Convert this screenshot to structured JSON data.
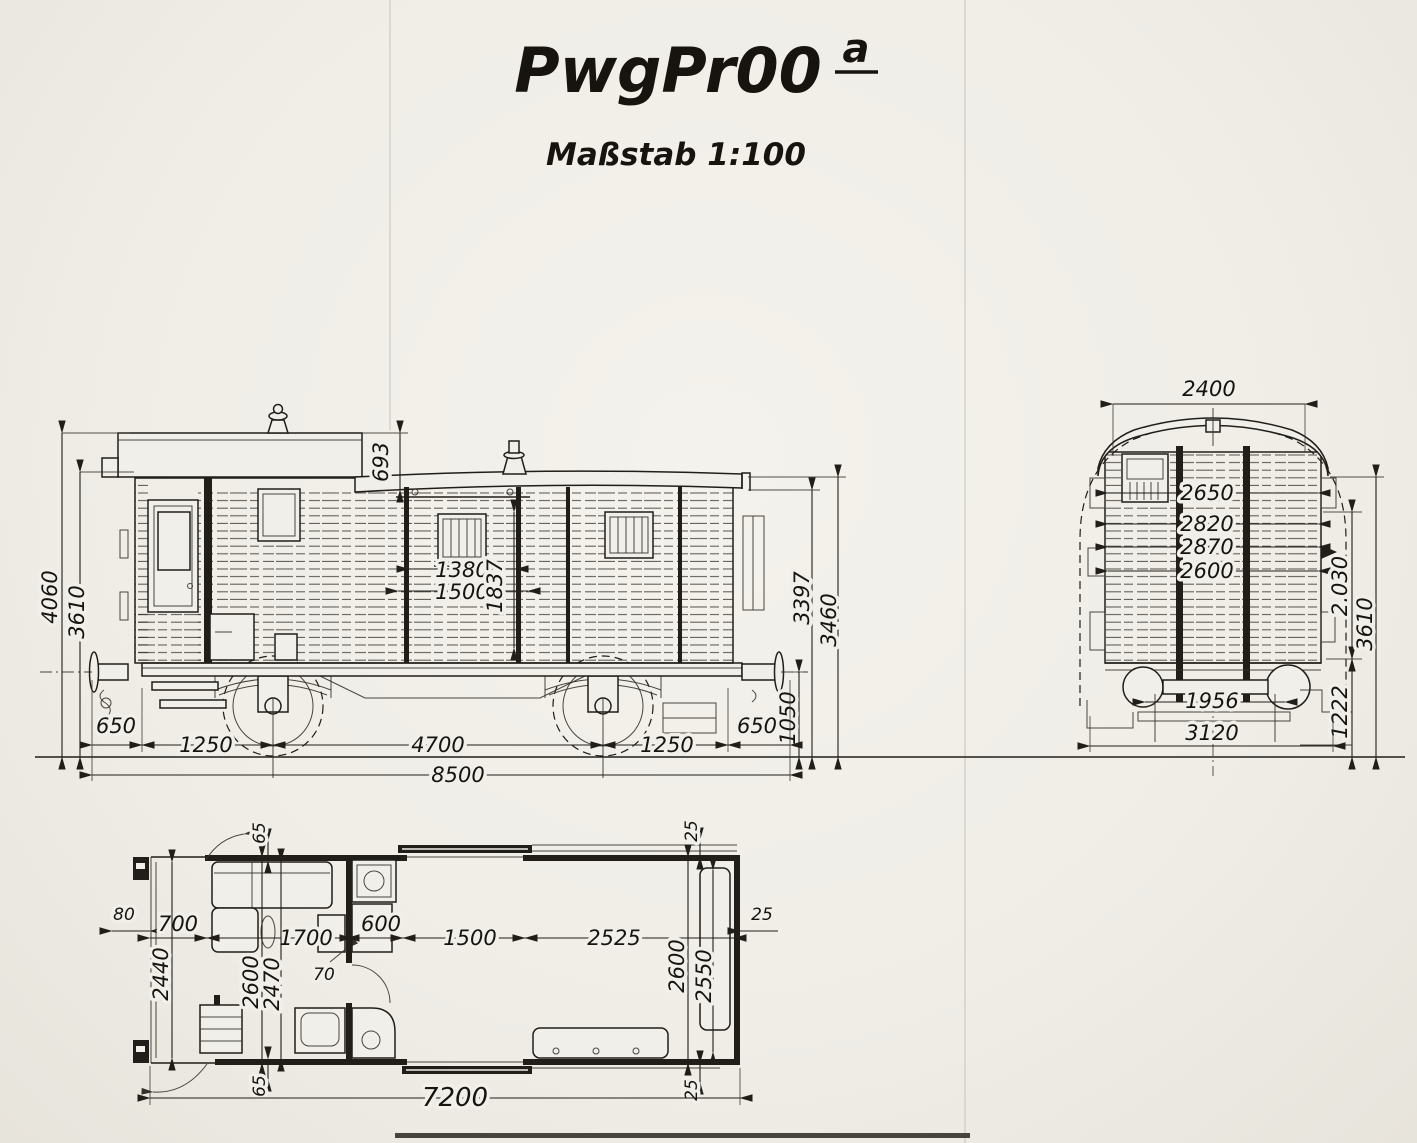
{
  "title": {
    "main": "PwgPr00",
    "superscript": "a"
  },
  "subtitle": "Maßstab 1:100",
  "side_view": {
    "dims": {
      "total_height": "4060",
      "roof_edge_height": "3610",
      "lantern_height": "693",
      "door_clear_width": "1380",
      "door_width": "1500",
      "door_height": "1837",
      "wall_top_height": "3397",
      "roof_top_height": "3460",
      "buffer_height": "1050",
      "left_overhang": "650",
      "left_axle": "1250",
      "wheelbase": "4700",
      "right_axle": "1250",
      "right_overhang": "650",
      "length_over_buffers": "8500"
    }
  },
  "end_view": {
    "dims": {
      "roof_width": "2400",
      "width_a": "2650",
      "width_b": "2820",
      "width_c": "2870",
      "width_d": "2600",
      "upper_height": "2.030",
      "body_height": "3610",
      "floor_height": "1222",
      "wheel_back_gauge": "1956",
      "axle_guard_width": "3120"
    }
  },
  "floor_plan": {
    "dims": {
      "buffer": "80",
      "seat_depth": "700",
      "wall_top": "65",
      "compartment": "1700",
      "cupboard": "600",
      "door_opening": "1500",
      "freight_length": "2525",
      "wall_right": "25",
      "compartment_width": "2440",
      "inner_width": "2600",
      "clear_width": "2470",
      "post": "70",
      "freight_inner_width": "2600",
      "freight_clear_width": "2550",
      "wall_bottom": "65",
      "wall_top_right": "25",
      "wall_bottom_right": "25",
      "total_length": "7200"
    }
  }
}
